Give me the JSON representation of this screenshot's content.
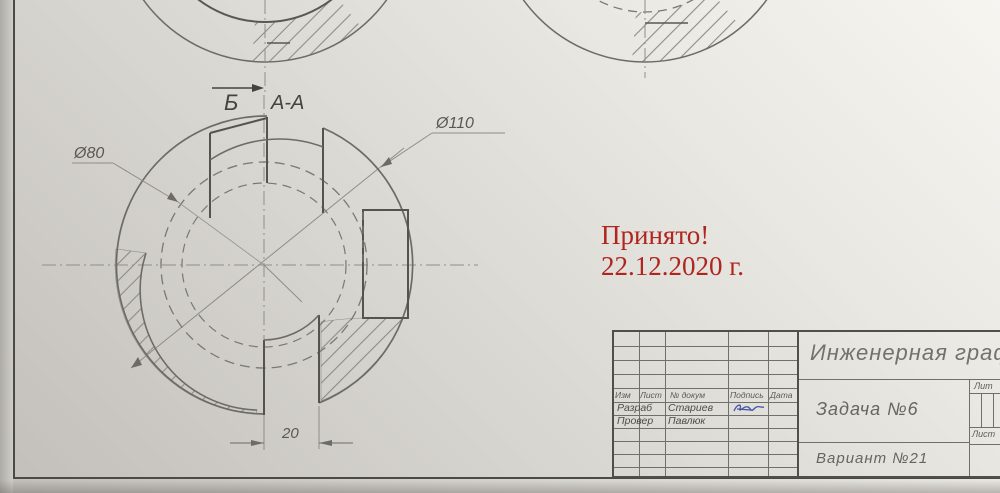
{
  "drawing": {
    "cut_label": "Б",
    "section_label": "А-А",
    "dim_inner": "Ø80",
    "dim_outer": "Ø110",
    "dim_slot": "20"
  },
  "stamp": {
    "line1": "Принято!",
    "line2": "22.12.2020 г.",
    "color": "#b1251f"
  },
  "title_block": {
    "doc_title": "Инженерная графика",
    "task": "Задача №6",
    "variant": "Вариант №21",
    "columns": {
      "izm": "Изм",
      "list": "Лист",
      "doc_no": "№ докум",
      "sign": "Подпись",
      "date": "Дата"
    },
    "roles": [
      {
        "label": "Разраб",
        "name": "Стариев"
      },
      {
        "label": "Провер",
        "name": "Павлюк"
      }
    ],
    "lit": "Лит",
    "sheet": "Лист",
    "signature_color": "#4353a8"
  }
}
